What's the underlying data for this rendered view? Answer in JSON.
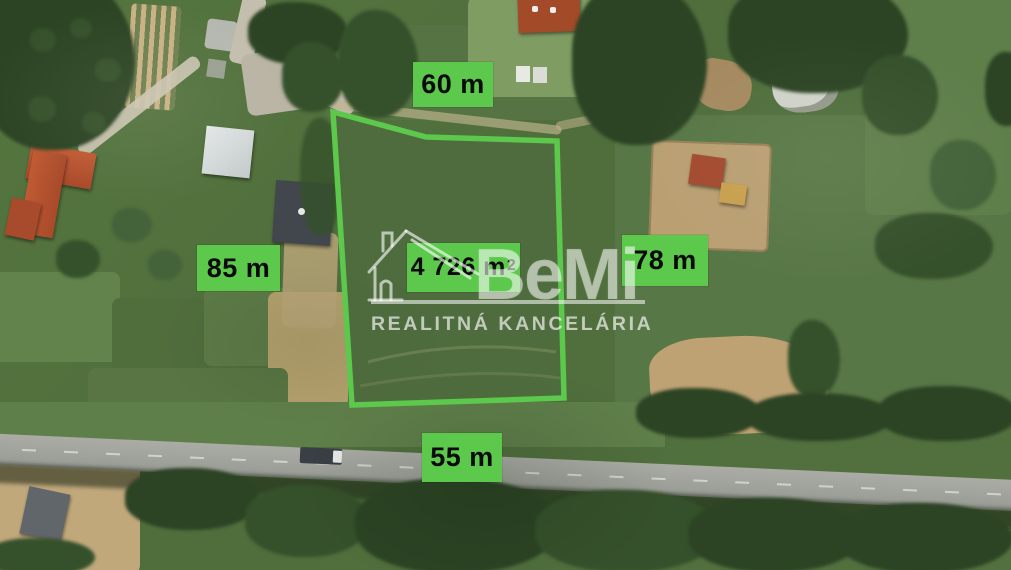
{
  "plot": {
    "outline_points": "333,112 426,137 557,141 564,398 352,405",
    "area": {
      "value": "4 726 m",
      "superscript": "2"
    },
    "measurements": {
      "top": "60 m",
      "left": "85 m",
      "right": "78 m",
      "bottom": "55 m"
    }
  },
  "watermark": {
    "brand": "BeMi",
    "subtitle": "REALITNÁ KANCELÁRIA"
  },
  "colors": {
    "accent_green": "#5cc84c",
    "label_text": "#0a0a0a"
  }
}
